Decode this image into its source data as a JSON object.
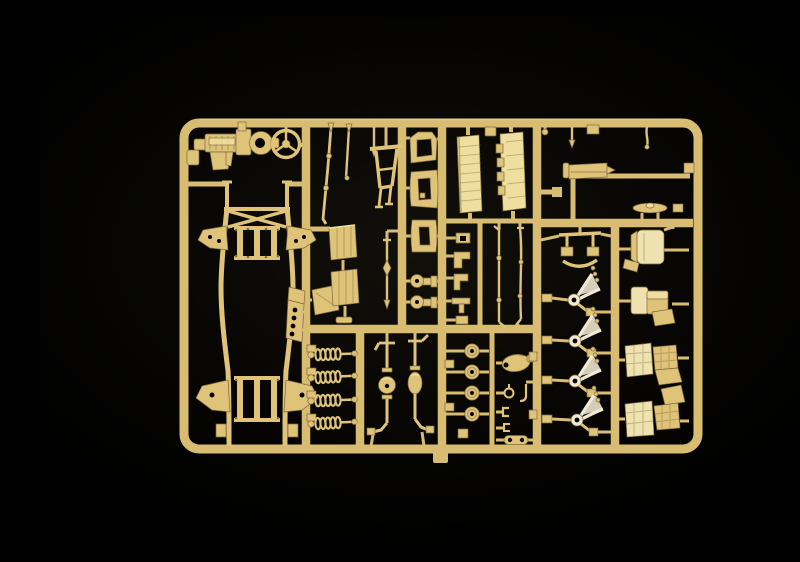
{
  "figure": {
    "type": "photograph",
    "alt": "Tan injection-molded model kit sprue (plastic parts tree) photographed on a black background",
    "palette": {
      "bg_center": "#12100b",
      "bg_edge": "#000000",
      "runner": "#d8bc72",
      "base": "#dec379",
      "light": "#efdf9f",
      "cream": "#eee2b0",
      "pale": "#f1e9d2",
      "dark": "#7e6a3c",
      "hole": "#060503"
    },
    "sprue": {
      "material": "tan styrene plastic",
      "frame_shape": "rounded rectangle runner frame with internal runner grid",
      "parts_inventory": [
        {
          "part": "engine-with-transmission",
          "quantity": 1,
          "location": "top-left cell"
        },
        {
          "part": "steering-wheel",
          "quantity": 1,
          "location": "top-left cell"
        },
        {
          "part": "chassis-ladder-frame",
          "quantity": 1,
          "location": "left column, full height"
        },
        {
          "part": "drilled-mounting-plate",
          "quantity": 1,
          "location": "left-center"
        },
        {
          "part": "tie-rods",
          "quantity": 3,
          "location": "upper second column"
        },
        {
          "part": "a-frame-bracket",
          "quantity": 1,
          "location": "upper second column"
        },
        {
          "part": "ribbed-floor-panels",
          "quantity": 2,
          "location": "second column middle"
        },
        {
          "part": "angled-panel",
          "quantity": 1,
          "location": "second column lower-middle"
        },
        {
          "part": "pointer-rod",
          "quantity": 1,
          "location": "center"
        },
        {
          "part": "open-frame-brackets",
          "quantity": 3,
          "location": "third column"
        },
        {
          "part": "disc-end-mounts",
          "quantity": 2,
          "location": "third column lower"
        },
        {
          "part": "cargo-side-panels",
          "quantity": 2,
          "location": "upper middle cell"
        },
        {
          "part": "small-clips",
          "quantity": 5,
          "location": "mid small-parts column"
        },
        {
          "part": "linkage-rods",
          "quantity": 2,
          "location": "mid cell"
        },
        {
          "part": "coil-spring-shock-absorbers",
          "quantity": 4,
          "location": "lower second column"
        },
        {
          "part": "axles-with-differential",
          "quantity": 2,
          "location": "lower middle cell"
        },
        {
          "part": "road-wheel-hub-discs",
          "quantity": 4,
          "location": "lower middle-right column"
        },
        {
          "part": "winch-housing",
          "quantity": 1,
          "location": "lower middle-right"
        },
        {
          "part": "tow-hooks-and-clips",
          "quantity": 4,
          "location": "lower middle-right"
        },
        {
          "part": "drag-link",
          "quantity": 1,
          "location": "lower middle-right"
        },
        {
          "part": "suspension-yoke",
          "quantity": 1,
          "location": "right-center column top"
        },
        {
          "part": "steering-knuckles",
          "quantity": 4,
          "location": "right-center column"
        },
        {
          "part": "seats",
          "quantity": 4,
          "location": "right column"
        },
        {
          "part": "tow-bar",
          "quantity": 1,
          "location": "top-right cell"
        },
        {
          "part": "leaf-spring-blade",
          "quantity": 1,
          "location": "top-right above runner"
        },
        {
          "part": "short-pin-rods",
          "quantity": 2,
          "location": "top-right cell"
        },
        {
          "part": "sprue-ejector-tab",
          "quantity": 1,
          "location": "below bottom runner"
        }
      ]
    }
  }
}
